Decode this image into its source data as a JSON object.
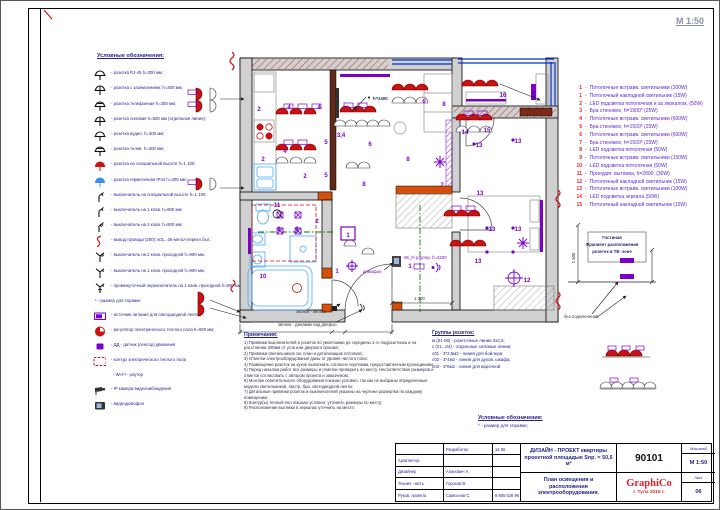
{
  "sheet": {
    "scale_note": "М 1:50"
  },
  "colors": {
    "fixture_red": "#cc1111",
    "legend_blue": "#23238e",
    "list_num_red": "#e8192c",
    "list_text_purple": "#5a1ed2",
    "brand_red": "#e01b24",
    "wall_gray": "#d0d0d0",
    "window_blue": "#0033cc",
    "symbol_purple": "#7a00cc",
    "section_green": "#008000",
    "wall_orange": "#d4500a"
  },
  "legend": {
    "title": "Условные обозначения:",
    "items": [
      {
        "icon": "socket-icon",
        "label": "- розетка RJ-45 h=300 мм;"
      },
      {
        "icon": "socket-grounded-icon",
        "label": "- розетка с заземлением; h=300 мм;"
      },
      {
        "icon": "socket-phone-icon",
        "label": "- розетка телефонная h=300 мм;"
      },
      {
        "icon": "socket-power-icon",
        "label": "- розетка силовая h=600 мм (отдельная линия);"
      },
      {
        "icon": "socket-audio-icon",
        "label": "- розетка аудио, h=300 мм;"
      },
      {
        "icon": "socket-tv-icon",
        "label": "- розетка телев. h=300 мм;"
      },
      {
        "icon": "socket-special-height-icon",
        "label": "- розетка на специальной высоте h=1 100;"
      },
      {
        "icon": "socket-ip44-icon",
        "label": "- розетка герметичная IP44 h=300 мм;"
      },
      {
        "icon": "switch-special-height-icon",
        "label": "- выключатель на специальной высоте h=1 100;"
      },
      {
        "icon": "switch-1key-icon",
        "label": "- выключатель на 1 клав. h=900 мм;"
      },
      {
        "icon": "switch-2key-icon",
        "label": "- выключатель на 2 клав. h=900 мм;"
      },
      {
        "icon": "wire-exit-icon",
        "label": "- вывод провода (200); к01...06-метал перекл.быт;"
      },
      {
        "icon": "switch-2key-pass-icon",
        "label": "- выключатель на 2 клав. проходной h=900 мм;"
      },
      {
        "icon": "switch-1key-pass-icon",
        "label": "- выключатель на 1 клав. проходной h=900 мм;"
      },
      {
        "icon": "switch-intermediate-icon",
        "label": "- промежуточный переключатель на 1 клав. проходной h=900 мм;"
      },
      {
        "icon": "none",
        "label": "* - размер для справки"
      },
      {
        "icon": "led-psu-icon",
        "label": "- источник питания для светодиодной ленты;"
      },
      {
        "icon": "floor-heating-regulator-icon",
        "label": "- регулятор электрического теплого пола h=600 мм;"
      },
      {
        "icon": "motion-sensor-icon",
        "label": "- ДД - датчик (сенсор) движения"
      },
      {
        "icon": "floor-heating-contour-icon",
        "label": "- контур электрического теплого пола"
      },
      {
        "icon": "none",
        "label": "- Wi-Fi - роутер"
      },
      {
        "icon": "ip-camera-icon",
        "label": "- IP камера видеонаблюдения"
      },
      {
        "icon": "intercom-icon",
        "label": "- видеодомофон"
      }
    ]
  },
  "fixtures": {
    "dash": "-",
    "items": [
      {
        "num": "1",
        "label": "Потолочные встраив. светильники (300W)"
      },
      {
        "num": "1",
        "label": "Потолочный накладной светильник (15W)"
      },
      {
        "num": "2",
        "label": "LED подсветка потолочная и за зеркалом, (50W)"
      },
      {
        "num": "3",
        "label": "Бра стеновое, h=1500* (25W)"
      },
      {
        "num": "4",
        "label": "Потолочные встраив. светильники (600W)"
      },
      {
        "num": "5",
        "label": "Бра стеновое, h=1500* (25W)"
      },
      {
        "num": "6",
        "label": "Потолочные встраив. светильники (600W)"
      },
      {
        "num": "7",
        "label": "Бра стеновое, h=1500* (25W)"
      },
      {
        "num": "8",
        "label": "LED подсветка потолочная (50W)"
      },
      {
        "num": "9",
        "label": "Потолочные встраив. светильники (150W)"
      },
      {
        "num": "10",
        "label": "LED подсветка потолочная (50W)"
      },
      {
        "num": "11",
        "label": "Принудит. вытяжка, h=2800, (30W)"
      },
      {
        "num": "12",
        "label": "Потолочный накладной светильник (15W)"
      },
      {
        "num": "13",
        "label": "Потолочные встраив. светильники (100W)"
      },
      {
        "num": "14",
        "label": "LED подсветка зеркала (50W)"
      },
      {
        "num": "15",
        "label": "Потолочный накладной светильник (15W)"
      }
    ]
  },
  "notes": {
    "title": "Примечания:",
    "items": [
      "1) Привязки выключателей и розеток по умолчанию до середины 1-го подрозетника и на расстоянии 200мм от угла или дверного проема;",
      "2) Привязки светильников см. план и детализацию потолков;",
      "3) Отметки электрооборудования даны от уровня чистого пола;",
      "4) Размещение розеток на кухне выполнить согласно чертежам, предоставленным кухонщиками;",
      "5) Перед началом работ все размеры и отметки проверить по месту. Несоответствие размеров и отметок согласовать с автором проекта и заказчиком;",
      "6) Монтаж осветительного оборудования показан условно, так как не выбраны определенные модели светильников, люстр, бра, светодиодной ленты;",
      "7) Детальные привязки розеток и выключателей указаны на чертеже развертки по каждому помещению;",
      "8) Контур(ы) теплый пол показан условно; уточнить размеры по месту;",
      "9) Расположение вытяжки в зеркалах уточнить на месте;"
    ]
  },
  "socket_groups": {
    "title": "Группы розеток:",
    "items": [
      "м (01-08) - розеточные линии 3х2,5;",
      "с (01...04) - отдельные силовые линии;",
      "с01 - 3*2,5м2 - линия для бойлера;",
      "с02 - 3*4м2 - линия для духов. шкафа;",
      "с03 - 3*6м2 - линия для варочной"
    ]
  },
  "legend2": {
    "title": "Условные обозначения:",
    "items": [
      "* - размер для справки;"
    ]
  },
  "plan": {
    "markers": [
      {
        "t": "2"
      },
      {
        "t": "4"
      },
      {
        "t": "4"
      },
      {
        "t": "3,4"
      },
      {
        "t": "2"
      },
      {
        "t": "4"
      },
      {
        "t": "5"
      },
      {
        "t": "5"
      },
      {
        "t": "2"
      },
      {
        "t": "6"
      },
      {
        "t": "8"
      },
      {
        "t": "8"
      },
      {
        "t": "7"
      },
      {
        "t": "6"
      },
      {
        "t": "8"
      },
      {
        "t": "16"
      },
      {
        "t": "11"
      },
      {
        "t": "9"
      },
      {
        "t": "9"
      },
      {
        "t": "10"
      },
      {
        "t": "2"
      },
      {
        "t": "1"
      },
      {
        "t": "14"
      },
      {
        "t": "15"
      },
      {
        "t": "13"
      },
      {
        "t": "13"
      },
      {
        "t": "13"
      },
      {
        "t": "13"
      },
      {
        "t": "13"
      },
      {
        "t": "13"
      },
      {
        "t": "12"
      },
      {
        "t": "1"
      },
      {
        "t": "1"
      }
    ],
    "callouts": {
      "h2400": "h=2400",
      "wifi": "Wi_Fi роутер, h=2200",
      "domofon": "домофон",
      "bell_button": "звонок - кнопка",
      "bell_speaker": "звонок - динамик над дверью",
      "dim1200": "1 200"
    },
    "tv_fragment": {
      "room": "Гостиная",
      "line1": "Фрагмент расположения",
      "line2": "розеток в ТВ -зоне",
      "dim": "1 500",
      "note": "без подключения"
    }
  },
  "title_block": {
    "rows": [
      {
        "c1": "",
        "c2": "Разработал",
        "c3": "14.06"
      },
      {
        "c1": "Архитектор",
        "c2": "",
        "c3": ""
      },
      {
        "c1": "Дизайнер",
        "c2": "Аланович А.",
        "c3": ""
      },
      {
        "c1": "Технич. часть",
        "c2": "Горохов В.",
        "c3": ""
      },
      {
        "c1": "Руков. проекта",
        "c2": "Самсонов С.",
        "c3": "8 905 628 96 96"
      }
    ],
    "project_title": "ДИЗАЙН - ПРОЕКТ квартиры проектной площадью Sпр. = 50,6 м²",
    "sheet_title": "План освещения и расположения электрооборудования.",
    "code": "90101",
    "brand": "GraphiCo",
    "city_year": "г. Тула   2019 г.",
    "scale_label": "Масштаб",
    "scale": "М 1:50",
    "sheet_label": "Лист",
    "sheet_no": "06"
  }
}
